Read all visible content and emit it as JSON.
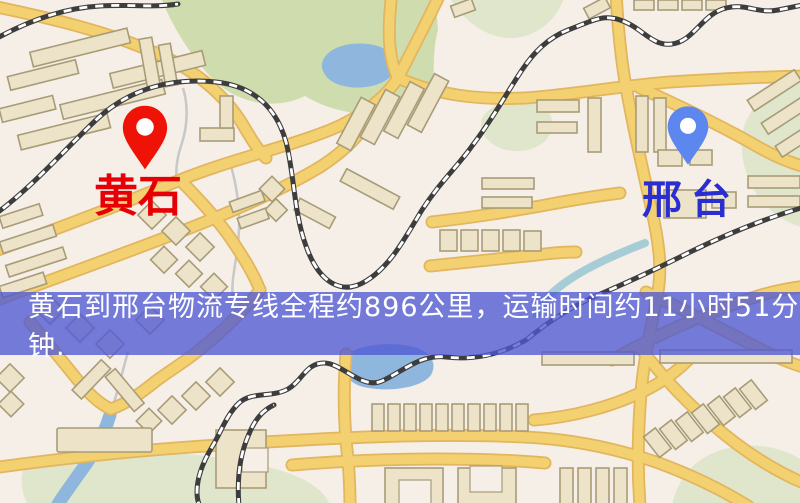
{
  "markers": {
    "origin": {
      "label": "黄石",
      "icon": "red-map-pin-icon"
    },
    "destination": {
      "label": "邢台",
      "icon": "blue-map-pin-icon"
    }
  },
  "banner": {
    "text": "黄石到邢台物流专线全程约896公里，运输时间约11小时51分钟."
  },
  "colors": {
    "background": "#f5efe7",
    "road": "#f4d170",
    "road_casing": "#e2b55e",
    "park": "#cfddae",
    "park_pale": "#dfe6cb",
    "water": "#8fb7dd",
    "stream": "#a6cdd6",
    "railway": "#3d3d3d",
    "building": "#ece3c9",
    "building_stroke": "#a89c78",
    "minor_road": "#c8c8c8",
    "banner_bg": "rgba(80,88,212,0.78)",
    "banner_text": "#ffffff",
    "origin_pin": "#ef1206",
    "origin_label": "#e60005",
    "destination_pin": "#5b87ee",
    "destination_label": "#2a2ed0"
  }
}
